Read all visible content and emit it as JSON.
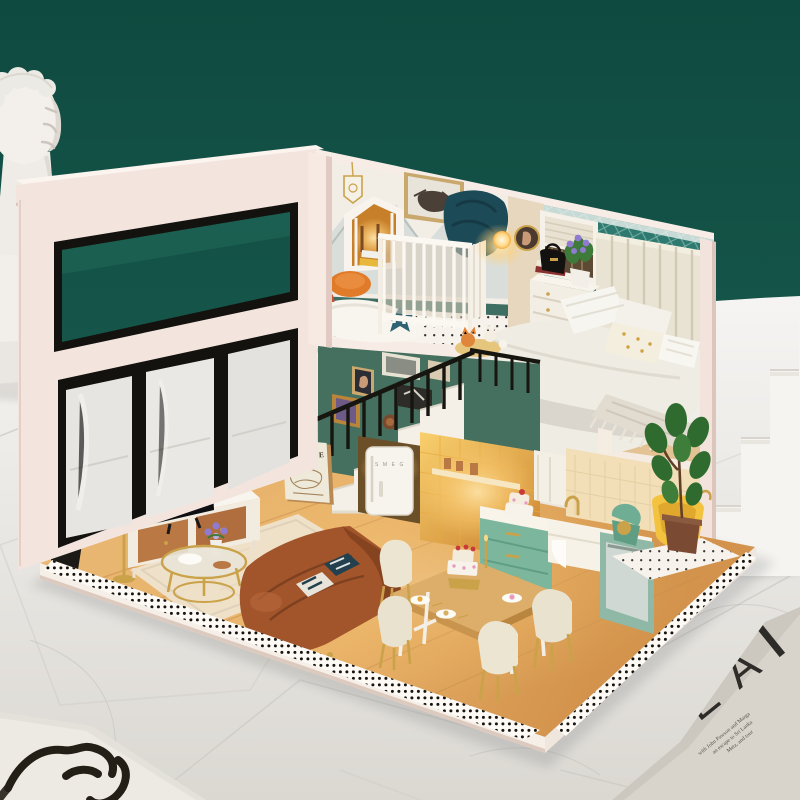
{
  "scene": {
    "subject": "DIY miniature dollhouse loft diorama photographed on white marble tiles against a dark teal wall",
    "staging_props": [
      "classical plaster bust",
      "white display steps",
      "design magazine with large letters",
      "line-art face print card"
    ]
  },
  "colors": {
    "bgTeal": "#16564a",
    "bgTealDark": "#0f4a40",
    "marble": "#edebe7",
    "marbleDeep": "#d9d6d0",
    "shell": "#f3e4de",
    "shellLight": "#faf1ec",
    "shellShade": "#e2cdc5",
    "tealWall": "#45705f",
    "wallpaper": "#2f7a70",
    "mural": "#f2eee6",
    "woodFloor": "#e0a55e",
    "woodLight": "#f0cd97",
    "cabinetGreen": "#7cb79d",
    "sofaBrown": "#a2552b",
    "sofaDark": "#86431f",
    "glow": "#ffcf76",
    "gold": "#c9973c",
    "ink": "#17150f",
    "tubYellow": "#f3c340"
  },
  "texts": {
    "matisse_poster_title": "MATISSE",
    "fridge_logo": "S M E G",
    "magazine_letters": [
      "E",
      "R",
      "E",
      "A"
    ],
    "magazine_lines": [
      "with John Pawson and Marga",
      "an escape to Sri Lanka",
      "Metz, and tour"
    ]
  },
  "rooms": {
    "nursery": [
      "white crib",
      "mountain mural",
      "highland cow picture",
      "house-shaped shelf",
      "rainbow toy",
      "sheepskin rug",
      "teal star cushion",
      "teddy bear",
      "black plant stand with yellow books"
    ],
    "bedroom": [
      "channel-tufted headboard",
      "double bed with grey throw",
      "gold-dot cushion",
      "white dresser",
      "purple flowers",
      "black handbag",
      "roman-shade window",
      "teal diamond wallpaper",
      "round portrait with sconce"
    ],
    "living_room": [
      "flat-screen TV",
      "media credenza",
      "glowing floor lamp",
      "gold coffee table",
      "brown leather sofa",
      "striped cushions",
      "cream rug",
      "gallery wall",
      "staircase with black railing",
      "MATISSE poster",
      "retro fridge",
      "monstera plant"
    ],
    "kitchen_dining": [
      "sage green cabinets",
      "farmhouse sink",
      "gold faucet",
      "stand mixer",
      "dishwasher",
      "yellow tub",
      "wooden dining table",
      "four cream chairs",
      "celebration cake",
      "fiddle-leaf fig plant"
    ]
  }
}
